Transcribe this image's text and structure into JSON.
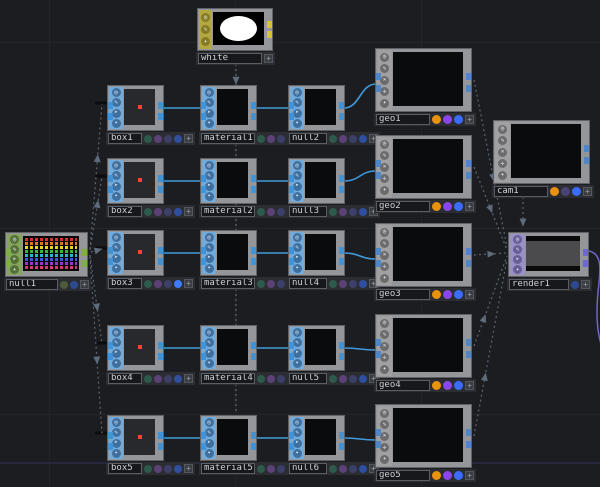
{
  "app": {
    "name": "TouchDesigner Network Editor"
  },
  "canvas": {
    "width": 600,
    "height": 487,
    "background": "#1b1d21",
    "grid_color": "#23252b",
    "grid_size": 186,
    "grid_offset_x": 49,
    "grid_offset_y": 42
  },
  "plus_label": "+",
  "glyphs": {
    "viewer-active-flag": "◎",
    "edit-flag": "✎",
    "bypass-flag": "➤",
    "display-flag": "✦",
    "render-flag": "✕",
    "pick-flag": "✛"
  },
  "families": {
    "SOP": {
      "strip": "#72aad9",
      "icon_bg": "#3e6f9f",
      "tab": "#3f93d6",
      "icons": [
        "viewer-active-flag",
        "edit-flag",
        "bypass-flag",
        "display-flag"
      ]
    },
    "CHOP": {
      "strip": "#85a45f",
      "icon_bg": "#55703a",
      "tab": "#7fae45",
      "icons": [
        "viewer-active-flag",
        "edit-flag",
        "bypass-flag",
        "display-flag"
      ]
    },
    "MAT": {
      "strip": "#b3a73f",
      "icon_bg": "#857b22",
      "tab": "#d6c436",
      "icons": [
        "viewer-active-flag",
        "edit-flag",
        "display-flag"
      ]
    },
    "COMP": {
      "strip": "#a0a0a2",
      "icon_bg": "#6b6b6e",
      "tab": "#4f86c6",
      "icons": [
        "viewer-active-flag",
        "edit-flag",
        "render-flag",
        "pick-flag",
        "display-flag"
      ]
    },
    "TOP": {
      "strip": "#9b90c4",
      "icon_bg": "#675d99",
      "tab": "#6f66d6",
      "icons": [
        "viewer-active-flag",
        "edit-flag",
        "bypass-flag",
        "display-flag"
      ]
    }
  },
  "flag_dot_colors": {
    "small": [
      "#2c5a4c",
      "#5c4177",
      "#3c3f68",
      "#2e4f9e"
    ],
    "box3": [
      "#2c5a4c",
      "#5c4177",
      "#3c3f68",
      "#3f7bff"
    ],
    "geo": [
      "#e8920f",
      "#8a46e8",
      "#3a6cff"
    ],
    "cam": [
      "#e8920f",
      "#4a4476",
      "#3a6cff"
    ],
    "chop": [
      "#4c5c3a",
      "#2e4a8e"
    ],
    "top": [
      "#2e4a8e"
    ],
    "mat": []
  },
  "chop_stripe_colors": [
    "#d83030",
    "#e07820",
    "#e8d820",
    "#38b838",
    "#28b8c8",
    "#3858e0",
    "#9838d0",
    "#d83878"
  ],
  "nodes": [
    {
      "id": "white",
      "label": "white",
      "family": "MAT",
      "x": 197,
      "y": 8,
      "w": 76,
      "h": 43,
      "viewer": "white-view",
      "name_w": 64,
      "dots": "mat",
      "tabs": {
        "left": false,
        "right": true
      }
    },
    {
      "id": "null1",
      "label": "null1",
      "family": "CHOP",
      "x": 5,
      "y": 232,
      "w": 83,
      "h": 45,
      "viewer": "chop-view",
      "name_w": 52,
      "dots": "chop",
      "tabs": {
        "left": true,
        "right": true
      }
    },
    {
      "id": "box1",
      "label": "box1",
      "family": "SOP",
      "x": 107,
      "y": 85,
      "w": 57,
      "h": 46,
      "viewer": "red-dot-view",
      "name_w": 34,
      "dots": "small",
      "tabs": {
        "left": true,
        "right": true
      }
    },
    {
      "id": "box2",
      "label": "box2",
      "family": "SOP",
      "x": 107,
      "y": 158,
      "w": 57,
      "h": 46,
      "viewer": "red-dot-view",
      "name_w": 34,
      "dots": "small",
      "tabs": {
        "left": true,
        "right": true
      }
    },
    {
      "id": "box3",
      "label": "box3",
      "family": "SOP",
      "x": 107,
      "y": 230,
      "w": 57,
      "h": 46,
      "viewer": "red-dot-view",
      "name_w": 34,
      "dots": "box3",
      "tabs": {
        "left": true,
        "right": true
      }
    },
    {
      "id": "box4",
      "label": "box4",
      "family": "SOP",
      "x": 107,
      "y": 325,
      "w": 57,
      "h": 46,
      "viewer": "red-dot-view",
      "name_w": 34,
      "dots": "small",
      "tabs": {
        "left": true,
        "right": true
      }
    },
    {
      "id": "box5",
      "label": "box5",
      "family": "SOP",
      "x": 107,
      "y": 415,
      "w": 57,
      "h": 46,
      "viewer": "red-dot-view",
      "name_w": 34,
      "dots": "small",
      "tabs": {
        "left": true,
        "right": true
      }
    },
    {
      "id": "material1",
      "label": "material1",
      "family": "SOP",
      "x": 200,
      "y": 85,
      "w": 57,
      "h": 46,
      "viewer": "black-view",
      "name_w": 54,
      "dots": "small",
      "tabs": {
        "left": true,
        "right": true
      }
    },
    {
      "id": "material2",
      "label": "material2",
      "family": "SOP",
      "x": 200,
      "y": 158,
      "w": 57,
      "h": 46,
      "viewer": "black-view",
      "name_w": 54,
      "dots": "small",
      "tabs": {
        "left": true,
        "right": true
      }
    },
    {
      "id": "material3",
      "label": "material3",
      "family": "SOP",
      "x": 200,
      "y": 230,
      "w": 57,
      "h": 46,
      "viewer": "black-view",
      "name_w": 54,
      "dots": "small",
      "tabs": {
        "left": true,
        "right": true
      }
    },
    {
      "id": "material4",
      "label": "material4",
      "family": "SOP",
      "x": 200,
      "y": 325,
      "w": 57,
      "h": 46,
      "viewer": "black-view",
      "name_w": 54,
      "dots": "small",
      "tabs": {
        "left": true,
        "right": true
      }
    },
    {
      "id": "material5",
      "label": "material5",
      "family": "SOP",
      "x": 200,
      "y": 415,
      "w": 57,
      "h": 46,
      "viewer": "black-view",
      "name_w": 54,
      "dots": "small",
      "tabs": {
        "left": true,
        "right": true
      }
    },
    {
      "id": "null2",
      "label": "null2",
      "family": "SOP",
      "x": 288,
      "y": 85,
      "w": 57,
      "h": 46,
      "viewer": "black-view",
      "name_w": 38,
      "dots": "small",
      "tabs": {
        "left": true,
        "right": true
      }
    },
    {
      "id": "null3",
      "label": "null3",
      "family": "SOP",
      "x": 288,
      "y": 158,
      "w": 57,
      "h": 46,
      "viewer": "black-view",
      "name_w": 38,
      "dots": "small",
      "tabs": {
        "left": true,
        "right": true
      }
    },
    {
      "id": "null4",
      "label": "null4",
      "family": "SOP",
      "x": 288,
      "y": 230,
      "w": 57,
      "h": 46,
      "viewer": "black-view",
      "name_w": 38,
      "dots": "small",
      "tabs": {
        "left": true,
        "right": true
      }
    },
    {
      "id": "null5",
      "label": "null5",
      "family": "SOP",
      "x": 288,
      "y": 325,
      "w": 57,
      "h": 46,
      "viewer": "black-view",
      "name_w": 38,
      "dots": "small",
      "tabs": {
        "left": true,
        "right": true
      }
    },
    {
      "id": "null6",
      "label": "null6",
      "family": "SOP",
      "x": 288,
      "y": 415,
      "w": 57,
      "h": 46,
      "viewer": "black-view",
      "name_w": 38,
      "dots": "small",
      "tabs": {
        "left": true,
        "right": true
      }
    },
    {
      "id": "geo1",
      "label": "geo1",
      "family": "COMP",
      "x": 375,
      "y": 48,
      "w": 97,
      "h": 64,
      "viewer": "black-view",
      "name_w": 54,
      "dots": "geo",
      "tabs": {
        "left": true,
        "right": true
      }
    },
    {
      "id": "geo2",
      "label": "geo2",
      "family": "COMP",
      "x": 375,
      "y": 135,
      "w": 97,
      "h": 64,
      "viewer": "black-view",
      "name_w": 54,
      "dots": "geo",
      "tabs": {
        "left": true,
        "right": true
      }
    },
    {
      "id": "geo3",
      "label": "geo3",
      "family": "COMP",
      "x": 375,
      "y": 223,
      "w": 97,
      "h": 64,
      "viewer": "black-view",
      "name_w": 54,
      "dots": "geo",
      "tabs": {
        "left": true,
        "right": true
      }
    },
    {
      "id": "geo4",
      "label": "geo4",
      "family": "COMP",
      "x": 375,
      "y": 314,
      "w": 97,
      "h": 64,
      "viewer": "black-view",
      "name_w": 54,
      "dots": "geo",
      "tabs": {
        "left": true,
        "right": true
      }
    },
    {
      "id": "geo5",
      "label": "geo5",
      "family": "COMP",
      "x": 375,
      "y": 404,
      "w": 97,
      "h": 64,
      "viewer": "black-view",
      "name_w": 54,
      "dots": "geo",
      "tabs": {
        "left": true,
        "right": true
      }
    },
    {
      "id": "cam1",
      "label": "cam1",
      "family": "COMP",
      "x": 493,
      "y": 120,
      "w": 97,
      "h": 64,
      "viewer": "black-view",
      "name_w": 54,
      "dots": "cam",
      "tabs": {
        "left": false,
        "right": true
      }
    },
    {
      "id": "render1",
      "label": "render1",
      "family": "TOP",
      "x": 508,
      "y": 232,
      "w": 81,
      "h": 45,
      "viewer": "render-view",
      "name_w": 60,
      "dots": "top",
      "tabs": {
        "left": false,
        "right": true
      }
    }
  ],
  "wires": {
    "solid_color": "#3f9bdc",
    "solid": [
      [
        163,
        108,
        201,
        108
      ],
      [
        256,
        108,
        289,
        108
      ],
      [
        344,
        108,
        376,
        84
      ],
      [
        163,
        181,
        201,
        181
      ],
      [
        256,
        181,
        289,
        181
      ],
      [
        344,
        181,
        376,
        171
      ],
      [
        163,
        253,
        201,
        253
      ],
      [
        256,
        253,
        289,
        253
      ],
      [
        344,
        253,
        376,
        259
      ],
      [
        163,
        348,
        201,
        348
      ],
      [
        256,
        348,
        289,
        348
      ],
      [
        344,
        348,
        376,
        350
      ],
      [
        163,
        438,
        201,
        438
      ],
      [
        256,
        438,
        289,
        438
      ],
      [
        344,
        438,
        376,
        440
      ]
    ],
    "stub_color": "#0b0c0e",
    "stubs": [
      [
        95,
        103,
        121,
        103
      ],
      [
        95,
        176,
        121,
        176
      ],
      [
        95,
        248,
        121,
        248
      ],
      [
        95,
        343,
        121,
        343
      ],
      [
        95,
        433,
        121,
        433
      ]
    ],
    "dashed_color": "#5a6673",
    "arrow_color": "#5f6b7a",
    "dashed": [
      {
        "line": [
          90,
          249,
          102,
          104
        ],
        "t": 0.62
      },
      {
        "line": [
          90,
          250,
          102,
          177
        ],
        "t": 0.62
      },
      {
        "line": [
          91,
          252,
          102,
          249
        ],
        "t": 0.6
      },
      {
        "line": [
          90,
          255,
          102,
          344
        ],
        "t": 0.58
      },
      {
        "line": [
          90,
          257,
          102,
          434
        ],
        "t": 0.58
      },
      {
        "line": [
          236,
          64,
          236,
          413
        ],
        "t": 0.045
      },
      {
        "line": [
          474,
          80,
          507,
          247
        ],
        "t": 0.58
      },
      {
        "line": [
          474,
          167,
          507,
          250
        ],
        "t": 0.5
      },
      {
        "line": [
          474,
          255,
          507,
          253
        ],
        "t": 0.5
      },
      {
        "line": [
          474,
          346,
          507,
          256
        ],
        "t": 0.3
      },
      {
        "line": [
          474,
          436,
          507,
          259
        ],
        "t": 0.33
      },
      {
        "line": [
          523,
          197,
          523,
          227
        ],
        "t": 0.82
      }
    ],
    "purple_color": "#6f66c8",
    "purple_path": "M589,251 C602,254 601,268 598,292 C596,316 597,330 601,344",
    "hline": {
      "y": 463,
      "color": "#34315a"
    }
  }
}
